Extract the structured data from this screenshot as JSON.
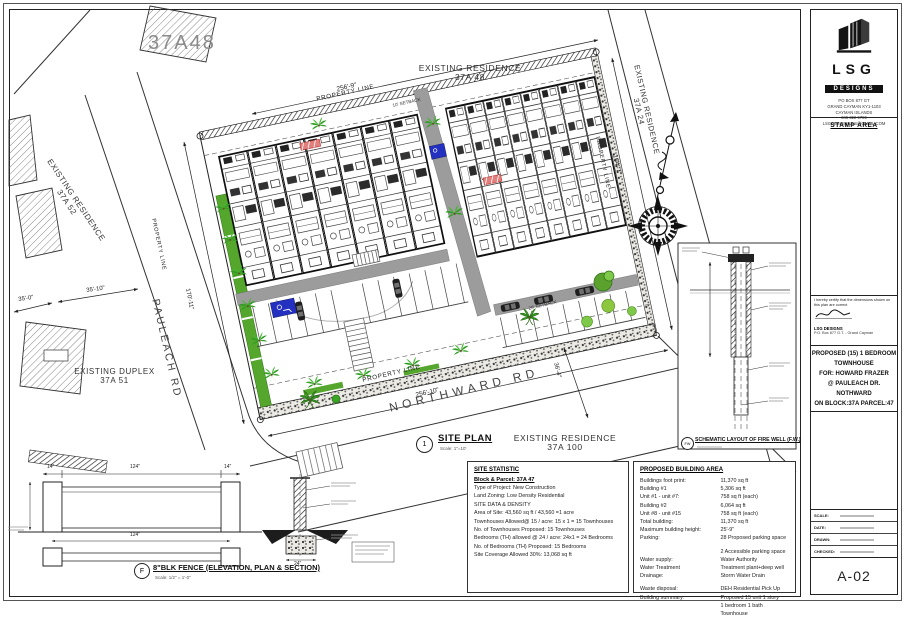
{
  "sheet": {
    "big_parcel_label": "37A48",
    "neighbors": {
      "res48": [
        "EXISTING RESIDENCE",
        "37A 48"
      ],
      "res52": [
        "EXISTING RESIDENCE",
        "37A 52"
      ],
      "duplex51": [
        "EXISTING DUPLEX",
        "37A 51"
      ],
      "res24": [
        "EXISTING RESIDENCE",
        "37A 24"
      ],
      "res100": [
        "EXISTING RESIDENCE",
        "37A 100"
      ]
    },
    "roads": {
      "west": "PAULEACH RD",
      "south": "NORTHWARD RD"
    },
    "property_line_label": "PROPERTY LINE",
    "setbacks": {
      "north": "10' SETBACK",
      "south": "20' SETBACK"
    },
    "dimensions": {
      "north": "256'-9\"",
      "east": "164'-7\"",
      "south": "256'-10\"",
      "west": "170'-11\"",
      "road_west_a": "35'-10\"",
      "road_west_b": "35'-0\"",
      "southeast": "36'-4\""
    },
    "site_plan_callout": {
      "number": "1",
      "title": "SITE PLAN",
      "scale": "Scale: 1\"=10'"
    }
  },
  "fire_well": {
    "tag": "FW",
    "title": "SCHEMATIC LAYOUT OF FIRE WELL (F.W.)"
  },
  "fence_detail": {
    "tag": "F",
    "title": "8\"BLK FENCE (ELEVATION, PLAN & SECTION)",
    "scale": "Scale: 1/2\" = 1'-0\"",
    "dim_post": "14\"",
    "dim_span": "124\"",
    "dim_footing": "24\""
  },
  "site_statistic": {
    "title": "SITE STATISTIC",
    "subtitle": "Block & Parcel: 37A 47",
    "lines": [
      "Type of Project: New Construction",
      "Land Zoning: Low Density Residential",
      "SITE DATA & DENSITY",
      "Area of Site: 43,560 sq ft / 43,560 =1 acre",
      "Townhouses Allowed@ 15 / acre: 15 x 1 = 15 Townhouses",
      "No. of Townhouses Proposed: 15 Townhouses",
      "Bedrooms (TH) allowed @ 24 / acre: 24x1 = 24 Bedrooms",
      "No. of Bedrooms (TH) Proposed: 15 Bedrooms",
      "Site Coverage Allowed 30%: 13,068 sq ft"
    ]
  },
  "building_area": {
    "title": "PROPOSED BUILDING AREA",
    "rows": [
      {
        "label": "Buildings foot print:",
        "value": "11,370 sq ft"
      },
      {
        "label": "Building #1",
        "value": "5,306 sq ft"
      },
      {
        "label": "Unit #1 - unit #7:",
        "value": "758 sq ft (each)"
      },
      {
        "label": "Building #2",
        "value": "6,064 sq ft"
      },
      {
        "label": "Unit #8 - unit #15",
        "value": "758 sq ft (each)"
      },
      {
        "label": "Total building:",
        "value": "11,370 sq ft"
      },
      {
        "label": "Maximum building height:",
        "value": "25'-9\""
      },
      {
        "label": "Parking:",
        "value": "28 Proposed parking space"
      },
      {
        "label": "",
        "value": "2 Accessible parking space"
      },
      {
        "label": "Water supply:",
        "value": "Water Authority"
      },
      {
        "label": "Water Treatment",
        "value": "Treatment plant+deep well"
      },
      {
        "label": "Drainage:",
        "value": "Storm Water Drain"
      },
      {
        "label": "Waste disposal:",
        "value": "DEH Residential Pick Up"
      },
      {
        "label": "Building summary:",
        "value": "Proposed 15 unit 1 story"
      },
      {
        "label": "",
        "value": "1 bedroom 1 bath Townhouse"
      }
    ]
  },
  "title_block": {
    "logo": {
      "acronym": "LSG",
      "word": "DESIGNS"
    },
    "address": [
      "PO BOX 877 GT",
      "GRAND CAYMAN KY1-1103",
      "CAYMAN ISLANDS",
      "345 322 9786",
      "LSGDESIGNSJLS@GMAIL.COM"
    ],
    "stamp_label": "STAMP AREA",
    "certification": {
      "statement": "I hereby certify that the dimensions shown on this plan are correct",
      "firm": "LSG DESIGNS",
      "address": "P.O. Box 877 G.T. - Grand Cayman"
    },
    "project": [
      "PROPOSED (15) 1 BEDROOM",
      "TOWNHOUSE",
      "FOR: HOWARD FRAZER",
      "@ PAULEACH DR.",
      "NOTHWARD",
      "ON  BLOCK:37A PARCEL:47"
    ],
    "notes": [
      "1. THE CONTRACTOR SHALL CHECK ALL DIMENSIONS BEFORE AND DURING CONSTRUCTION AND ANY DISCREPANCY FOUND MUST BE REPORTED TO THE ARCHITECT IMMEDIATELY.",
      "2. DIMENSIONS SHOWN MUST BE USED IN PREFERENCE TO SCALED DIMENSIONS.",
      "3. ALL DRAWINGS MUST BE READ IN CONJUNCTION WITH EACH OTHER."
    ],
    "fields": [
      {
        "label": "SCALE:"
      },
      {
        "label": "DATE:"
      },
      {
        "label": "DRAWN:"
      },
      {
        "label": "CHECKED:"
      }
    ],
    "sheet_number": "A-02"
  },
  "colors": {
    "landscape_green": "#55a62c",
    "accessible_blue": "#2430c0",
    "highlight_red": "#e2807d",
    "walkway_gray": "#9c9c9c"
  }
}
